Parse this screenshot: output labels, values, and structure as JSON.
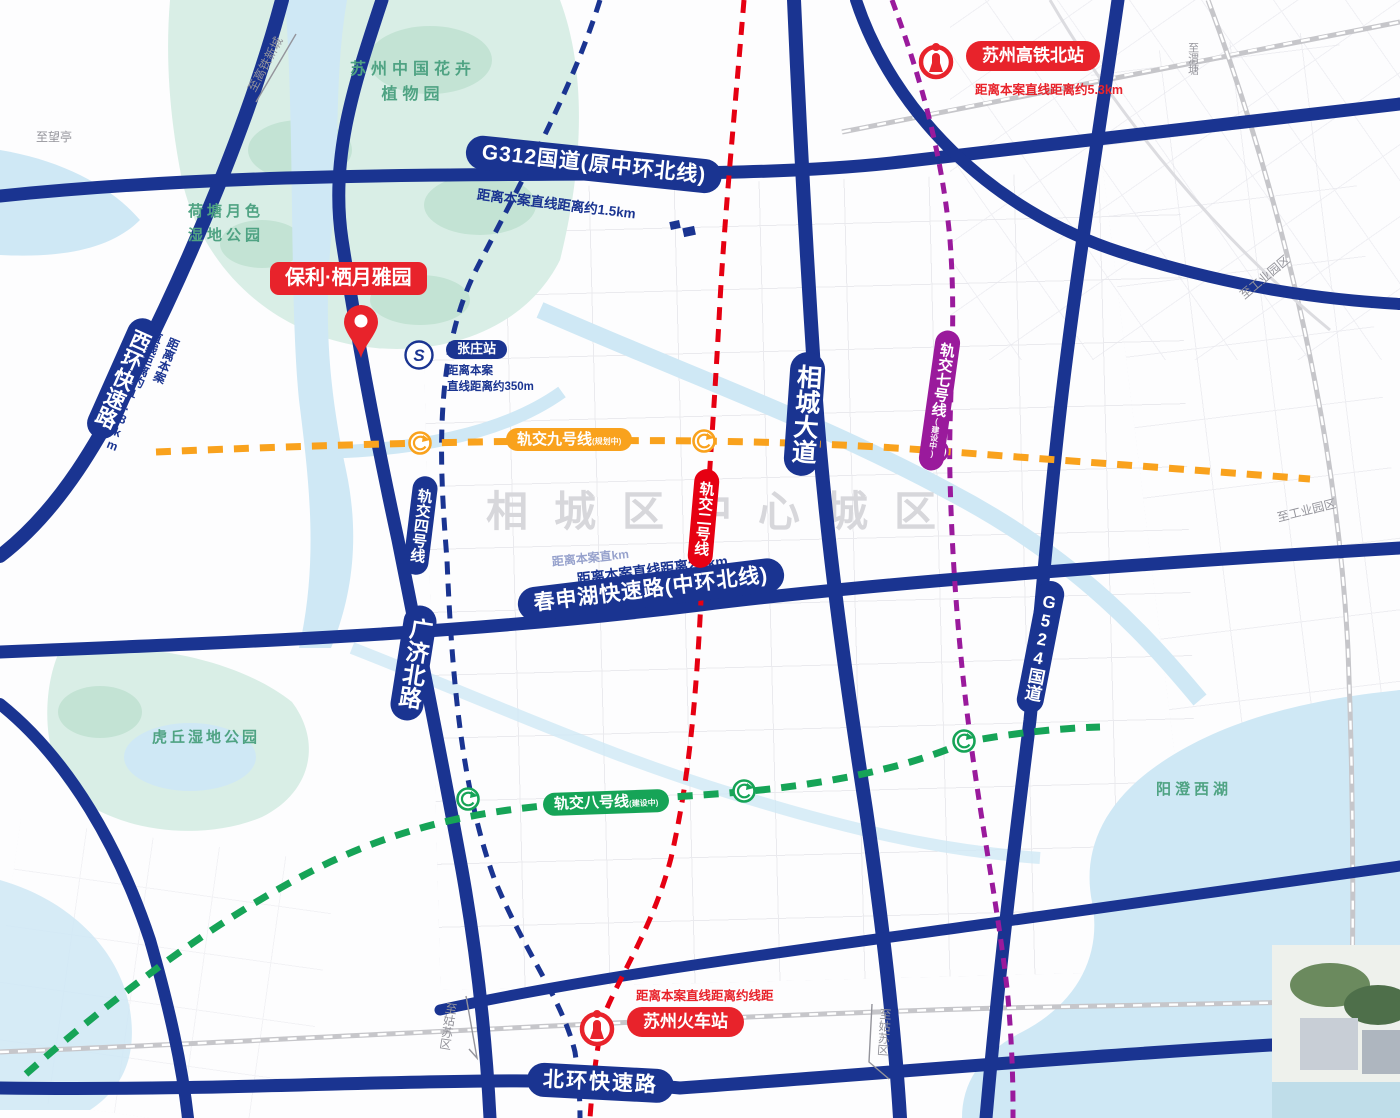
{
  "colors": {
    "navy": "#1a3491",
    "red": "#e8232b",
    "red2": "#e60012",
    "orange": "#f9a21d",
    "green": "#16a457",
    "purple": "#9a1a9c",
    "water": "#cfe8f5",
    "park": "#d9eee6",
    "parkdeep": "#c3e3d4",
    "parktext": "#4fa383",
    "rail": "#c6c6ca",
    "graytext": "#94949b",
    "watermark": "#d7d7db",
    "street": "#e9e9ee"
  },
  "project": {
    "banner": "保利·栖月雅园"
  },
  "stations": {
    "hsr_north": {
      "label": "苏州高铁北站",
      "distance": "距离本案直线距离约5.3km"
    },
    "suzhou": {
      "label": "苏州火车站",
      "distance": "距离本案直线距离约线距"
    },
    "zhangzhuang": {
      "label": "张庄站",
      "distance_line1": "距离本案",
      "distance_line2": "直线距离约350m"
    }
  },
  "roads": {
    "g312": {
      "label": "G312国道(原中环北线)",
      "distance": "距离本案直线距离约1.5km"
    },
    "zhonghuan": {
      "label": "春申湖快速路(中环北线)",
      "distance": "距离本案直线距离2.5km",
      "distance_ghost": "距离本案直km"
    },
    "beihuan": {
      "label": "北环快速路"
    },
    "xihuan": {
      "label": "西环快速路",
      "distance_line1": "距离本案",
      "distance_line2": "直线距离约1.8km"
    },
    "guangji": {
      "label": "广济北路"
    },
    "xiangcheng": {
      "label": "相城大道"
    },
    "g524": {
      "label": "G524国道"
    }
  },
  "metro": {
    "line2": {
      "label": "轨交二号线"
    },
    "line4": {
      "label": "轨交四号线"
    },
    "line7": {
      "label": "轨交七号线",
      "suffix": "(建设中)"
    },
    "line8": {
      "label": "轨交八号线",
      "suffix": "(建设中)"
    },
    "line9": {
      "label": "轨交九号线",
      "suffix": "(规划中)"
    }
  },
  "places": {
    "botanical": {
      "line1": "苏州中国花卉",
      "line2": "植物园"
    },
    "hetang": {
      "line1": "荷塘月色",
      "line2": "湿地公园"
    },
    "huqiu": {
      "label": "虎丘湿地公园"
    },
    "yangcheng": {
      "label": "阳澄西湖"
    }
  },
  "watermark": "相城区中心城区",
  "edge_labels": {
    "to_hsr_newtown": "至高铁新城",
    "to_wangting": "至望亭",
    "to_weitang": "至渭塘",
    "to_industrial_1": "至工业园区",
    "to_industrial_2": "至工业园区",
    "to_gusu_1": "至姑苏区",
    "to_gusu_2": "至姑苏区"
  }
}
